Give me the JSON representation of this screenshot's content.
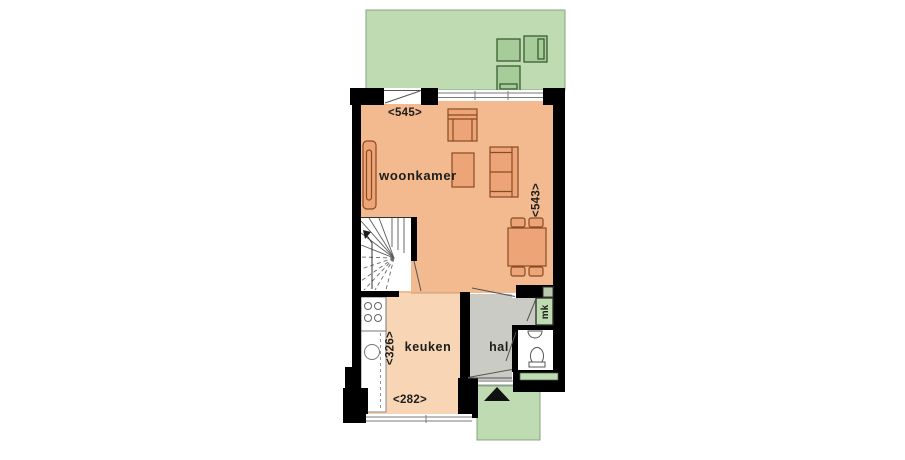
{
  "plan": {
    "rooms": {
      "woonkamer": "woonkamer",
      "keuken": "keuken",
      "hal": "hal",
      "mk": "mk"
    },
    "dimensions": {
      "living_width": "<545>",
      "living_depth": "<543>",
      "kitchen_depth": "<326>",
      "kitchen_width": "<282>"
    },
    "colors": {
      "garden": "#bedbb2",
      "garden_furniture": "#a6cd99",
      "garden_outline": "#3c5b33",
      "living": "#f3ba90",
      "kitchen": "#f8d5b5",
      "hall": "#c9cbc4",
      "furniture": "#eda577",
      "furniture_outline": "#8a4a22",
      "wall": "#000000",
      "label": "#1d1d1b",
      "white": "#ffffff"
    },
    "icons": {
      "entrance_arrow": "entrance-direction-arrow"
    }
  }
}
